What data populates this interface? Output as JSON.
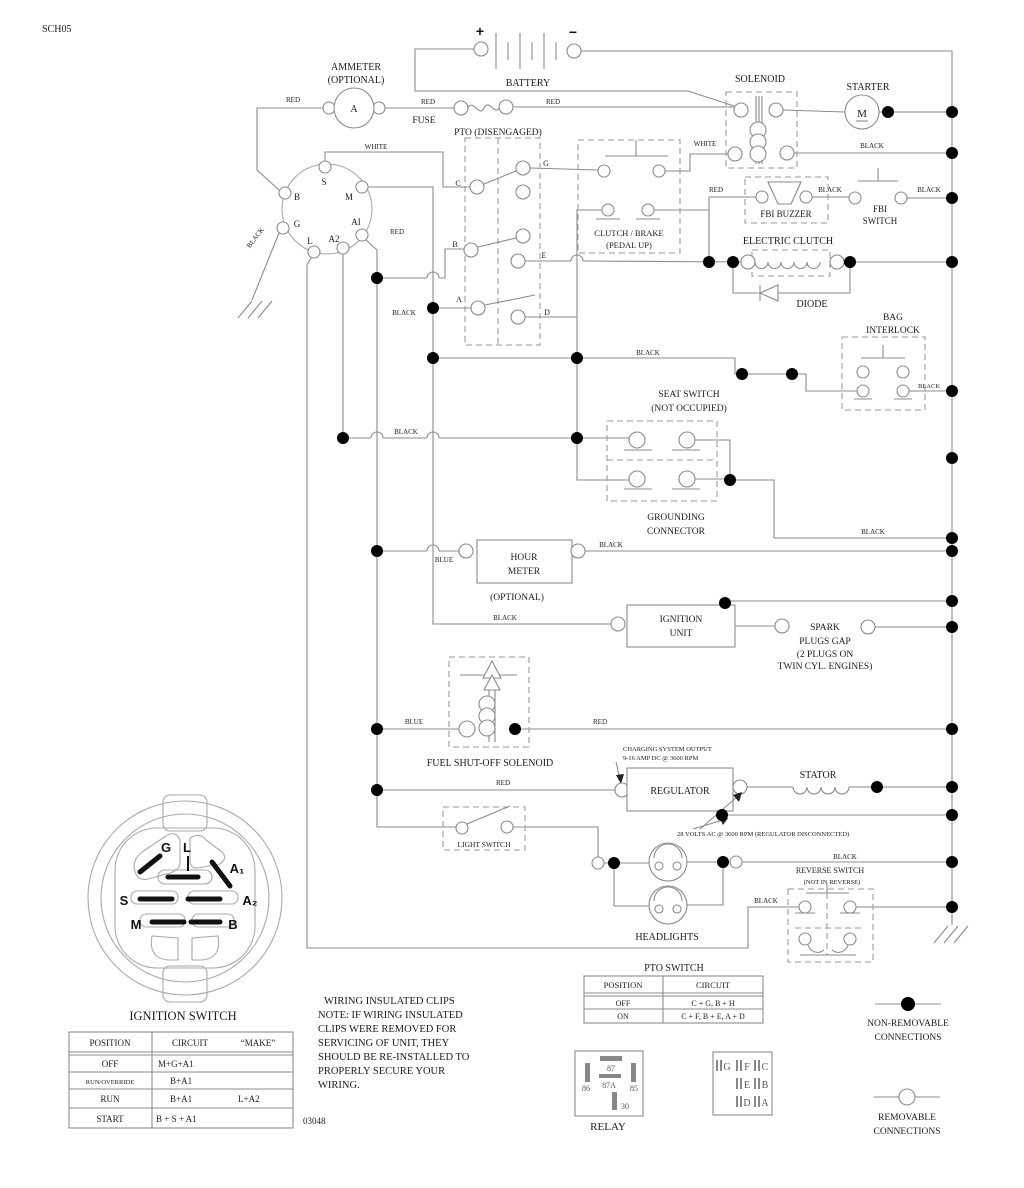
{
  "doc_code": "SCH05",
  "footer_code": "03048",
  "battery": {
    "label": "BATTERY",
    "plus": "+",
    "minus": "−"
  },
  "ammeter": {
    "l1": "AMMETER",
    "l2": "(OPTIONAL)",
    "meter": "A"
  },
  "fuse": "FUSE",
  "pto_header": "PTO (DISENGAGED)",
  "solenoid": "SOLENOID",
  "starter": {
    "label": "STARTER",
    "m": "M"
  },
  "fbi_buzzer": "FBI BUZZER",
  "fbi_switch": {
    "l1": "FBI",
    "l2": "SWITCH"
  },
  "clutch_brake": {
    "l1": "CLUTCH / BRAKE",
    "l2": "(PEDAL UP)"
  },
  "electric_clutch": "ELECTRIC CLUTCH",
  "diode": "DIODE",
  "bag_interlock": {
    "l1": "BAG",
    "l2": "INTERLOCK"
  },
  "seat_switch": {
    "l1": "SEAT SWITCH",
    "l2": "(NOT OCCUPIED)"
  },
  "grounding": {
    "l1": "GROUNDING",
    "l2": "CONNECTOR"
  },
  "hour_meter": {
    "l1": "HOUR",
    "l2": "METER",
    "l3": "(OPTIONAL)"
  },
  "ignition_unit": {
    "l1": "IGNITION",
    "l2": "UNIT"
  },
  "spark": {
    "l1": "SPARK",
    "l2": "PLUGS GAP",
    "l3": "(2 PLUGS ON",
    "l4": "TWIN CYL. ENGINES)"
  },
  "fuel_solenoid": "FUEL SHUT-OFF SOLENOID",
  "charging": {
    "l1": "CHARGING SYSTEM OUTPUT",
    "l2": "9-16 AMP DC @ 3600 RPM"
  },
  "regulator": "REGULATOR",
  "stator": "STATOR",
  "volts_note": "28 VOLTS AC @ 3600 RPM (REGULATOR DISCONNECTED)",
  "light_switch": "LIGHT SWITCH",
  "headlights": "HEADLIGHTS",
  "reverse_switch": {
    "l1": "REVERSE SWITCH",
    "l2": "(NOT IN REVERSE)"
  },
  "relay": {
    "label": "RELAY",
    "p87": "87",
    "p87a": "87A",
    "p86": "86",
    "p85": "85",
    "p30": "30"
  },
  "conn_block": {
    "g": "G",
    "f": "F",
    "c": "C",
    "e": "E",
    "b": "B",
    "d": "D",
    "a": "A"
  },
  "legend": {
    "nr1": "NON-REMOVABLE",
    "nr2": "CONNECTIONS",
    "r1": "REMOVABLE",
    "r2": "CONNECTIONS"
  },
  "ign_terminals": {
    "s": "S",
    "m": "M",
    "b": "B",
    "g": "G",
    "l": "L",
    "a1": "AI",
    "a2": "A2"
  },
  "pto_contacts": {
    "c": "C",
    "b": "B",
    "a": "A",
    "g": "G",
    "e": "E",
    "d": "D"
  },
  "wire_labels": {
    "red_amm": "RED",
    "red_fuse": "RED",
    "red_sol": "RED",
    "white_s": "WHITE",
    "white_sol": "WHITE",
    "black_sol": "BLACK",
    "red_buzzer": "RED",
    "black_buzzer": "BLACK",
    "black_fbi": "BLACK",
    "red_a1": "RED",
    "black_ign_gnd": "BLACK",
    "black_pto_a": "BLACK",
    "black_mid": "BLACK",
    "black_seat": "BLACK",
    "black_bag": "BLACK",
    "black_ground": "BLACK",
    "blue_hour": "BLUE",
    "black_hour": "BLACK",
    "black_unit": "BLACK",
    "blue_fuel": "BLUE",
    "red_fuel": "RED",
    "red_reg": "RED",
    "black_head": "BLACK",
    "black_rev": "BLACK"
  },
  "ign_plug": {
    "title": "IGNITION SWITCH",
    "g": "G",
    "l": "L",
    "a1": "A₁",
    "a2": "A₂",
    "s": "S",
    "m": "M",
    "b": "B"
  },
  "ign_table": {
    "h_pos": "POSITION",
    "h_circ": "CIRCUIT",
    "h_make": "“MAKE”",
    "rows": [
      {
        "pos": "OFF",
        "c1": "M+G+A1",
        "c2": ""
      },
      {
        "pos": "RUN/OVERRIDE",
        "c1": "B+A1",
        "c2": ""
      },
      {
        "pos": "RUN",
        "c1": "B+A1",
        "c2": "L+A2"
      },
      {
        "pos": "START",
        "c1": "B + S + A1",
        "c2": ""
      }
    ]
  },
  "pto_table": {
    "title": "PTO SWITCH",
    "h_pos": "POSITION",
    "h_circ": "CIRCUIT",
    "rows": [
      {
        "pos": "OFF",
        "circ": "C + G, B + H"
      },
      {
        "pos": "ON",
        "circ": "C + F, B + E, A + D"
      }
    ]
  },
  "note": {
    "l1": "WIRING INSULATED CLIPS",
    "l2": "NOTE: IF WIRING INSULATED",
    "l3": "CLIPS WERE REMOVED FOR",
    "l4": "SERVICING OF UNIT, THEY",
    "l5": "SHOULD BE RE-INSTALLED TO",
    "l6": "PROPERLY SECURE YOUR",
    "l7": "WIRING."
  }
}
